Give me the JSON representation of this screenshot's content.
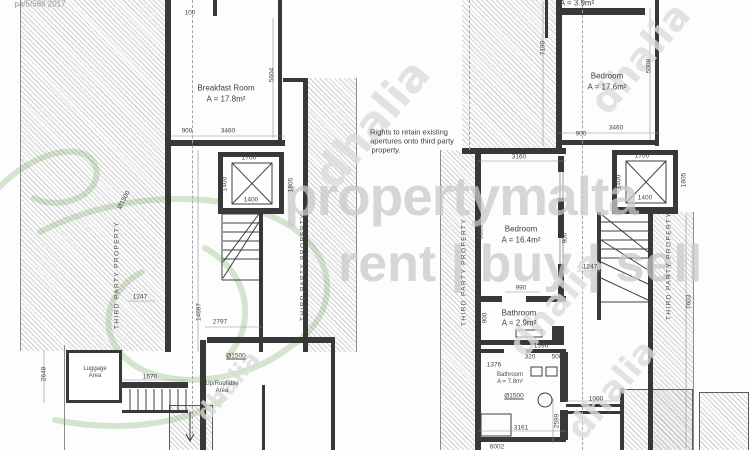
{
  "watermark": {
    "brand": "propertymalta",
    "tagline": "rent | buy | sell",
    "dhalia_text": "dhalia",
    "brand_color": "#c9c9c9",
    "dhalia_color": "#dcdcdc",
    "leaf_color": "#b9d6b0",
    "dhalia": [
      {
        "x": 640,
        "y": 58,
        "size": 38,
        "rot": -50
      },
      {
        "x": 372,
        "y": 124,
        "size": 44,
        "rot": -50
      },
      {
        "x": 556,
        "y": 304,
        "size": 36,
        "rot": -50
      },
      {
        "x": 228,
        "y": 386,
        "size": 24,
        "rot": -50
      },
      {
        "x": 612,
        "y": 390,
        "size": 34,
        "rot": -50
      }
    ]
  },
  "labels": [
    {
      "t": "pa/5/586 2017",
      "x": 40,
      "y": 4,
      "c": "ref",
      "n": "drawing-ref"
    },
    {
      "t": "100",
      "x": 190,
      "y": 13,
      "c": "dim"
    },
    {
      "t": "5604",
      "x": 272,
      "y": 75,
      "r": -90,
      "c": "dim"
    },
    {
      "t": "Breakfast Room",
      "x": 226,
      "y": 88,
      "c": "room",
      "n": "room-label-breakfast"
    },
    {
      "t": "A = 17.8m²",
      "x": 226,
      "y": 99,
      "c": "room",
      "n": "room-area-breakfast"
    },
    {
      "t": "900",
      "x": 187,
      "y": 131,
      "c": "dim"
    },
    {
      "t": "3460",
      "x": 228,
      "y": 131,
      "c": "dim"
    },
    {
      "t": "Ø1500",
      "x": 124,
      "y": 200,
      "r": -62,
      "c": "dim"
    },
    {
      "t": "1700",
      "x": 249,
      "y": 158,
      "c": "dim"
    },
    {
      "t": "1400",
      "x": 225,
      "y": 184,
      "r": -90,
      "c": "dim"
    },
    {
      "t": "1400",
      "x": 251,
      "y": 200,
      "c": "dim"
    },
    {
      "t": "1805",
      "x": 291,
      "y": 185,
      "r": -90,
      "c": "dim"
    },
    {
      "t": "1247",
      "x": 140,
      "y": 297,
      "c": "dim"
    },
    {
      "t": "THIRD PARTY PROPERTY",
      "x": 117,
      "y": 275,
      "r": -90,
      "c": "tpp",
      "n": "third-party-label"
    },
    {
      "t": "THIRD PARTY PROPERTY",
      "x": 303,
      "y": 267,
      "r": -90,
      "c": "tpp",
      "n": "third-party-label"
    },
    {
      "t": "14697",
      "x": 199,
      "y": 312,
      "r": -90,
      "c": "dim"
    },
    {
      "t": "2797",
      "x": 220,
      "y": 322,
      "c": "dim"
    },
    {
      "t": "Luggage",
      "x": 95,
      "y": 369,
      "c": "rooms",
      "n": "room-label-luggage"
    },
    {
      "t": "Area",
      "x": 95,
      "y": 376,
      "c": "rooms",
      "n": "room-label-luggage"
    },
    {
      "t": "1670",
      "x": 150,
      "y": 377,
      "c": "dim"
    },
    {
      "t": "Ø1500",
      "x": 236,
      "y": 356,
      "c": "dim under"
    },
    {
      "t": "Up/Roofable",
      "x": 222,
      "y": 384,
      "c": "rooms",
      "n": "room-label-roofable"
    },
    {
      "t": "Area",
      "x": 222,
      "y": 391,
      "c": "rooms",
      "n": "room-label-roofable"
    },
    {
      "t": "2648",
      "x": 44,
      "y": 374,
      "r": -90,
      "c": "dim"
    },
    {
      "t": "Rights to retain existing",
      "x": 409,
      "y": 132,
      "c": "note",
      "n": "apertures-note"
    },
    {
      "t": "apertures onto third party",
      "x": 412,
      "y": 141,
      "c": "note",
      "n": "apertures-note"
    },
    {
      "t": "property.",
      "x": 386,
      "y": 150,
      "c": "note",
      "n": "apertures-note"
    },
    {
      "t": "7190",
      "x": 543,
      "y": 48,
      "r": -90,
      "c": "dim"
    },
    {
      "t": "A = 3.9m²",
      "x": 577,
      "y": 3,
      "c": "room",
      "n": "room-area-top"
    },
    {
      "t": "Bedroom",
      "x": 607,
      "y": 76,
      "c": "room",
      "n": "room-label-bedroom-1"
    },
    {
      "t": "A = 17.6m²",
      "x": 607,
      "y": 87,
      "c": "room",
      "n": "room-area-bedroom-1"
    },
    {
      "t": "5008",
      "x": 649,
      "y": 66,
      "r": -90,
      "c": "dim"
    },
    {
      "t": "900",
      "x": 581,
      "y": 134,
      "c": "dim"
    },
    {
      "t": "3460",
      "x": 616,
      "y": 128,
      "c": "dim"
    },
    {
      "t": "1700",
      "x": 642,
      "y": 156,
      "c": "dim"
    },
    {
      "t": "1400",
      "x": 619,
      "y": 182,
      "r": -90,
      "c": "dim"
    },
    {
      "t": "1400",
      "x": 645,
      "y": 198,
      "c": "dim"
    },
    {
      "t": "1805",
      "x": 684,
      "y": 180,
      "r": -90,
      "c": "dim"
    },
    {
      "t": "3160",
      "x": 519,
      "y": 157,
      "c": "dim"
    },
    {
      "t": "Bedroom",
      "x": 521,
      "y": 229,
      "c": "room",
      "n": "room-label-bedroom-2"
    },
    {
      "t": "A = 16.4m²",
      "x": 521,
      "y": 240,
      "c": "room",
      "n": "room-area-bedroom-2"
    },
    {
      "t": "5359",
      "x": 481,
      "y": 232,
      "r": -90,
      "c": "dim"
    },
    {
      "t": "900",
      "x": 565,
      "y": 238,
      "r": -90,
      "c": "dim"
    },
    {
      "t": "1247",
      "x": 590,
      "y": 267,
      "c": "dim"
    },
    {
      "t": "THIRD PARTY PROPERTY",
      "x": 464,
      "y": 272,
      "r": -90,
      "c": "tpp",
      "n": "third-party-label"
    },
    {
      "t": "THIRD PARTY PROPERTY",
      "x": 669,
      "y": 266,
      "r": -90,
      "c": "tpp",
      "n": "third-party-label"
    },
    {
      "t": "7603",
      "x": 689,
      "y": 302,
      "r": -90,
      "c": "dim"
    },
    {
      "t": "990",
      "x": 521,
      "y": 288,
      "c": "dim"
    },
    {
      "t": "Bathroom",
      "x": 519,
      "y": 313,
      "c": "room",
      "n": "room-label-bathroom-1"
    },
    {
      "t": "A = 2.9m²",
      "x": 519,
      "y": 323,
      "c": "room",
      "n": "room-area-bathroom-1"
    },
    {
      "t": "900",
      "x": 485,
      "y": 318,
      "r": -90,
      "c": "dim"
    },
    {
      "t": "1596",
      "x": 541,
      "y": 346,
      "c": "dim"
    },
    {
      "t": "320",
      "x": 530,
      "y": 357,
      "c": "dim"
    },
    {
      "t": "500",
      "x": 557,
      "y": 357,
      "c": "dim"
    },
    {
      "t": "1376",
      "x": 494,
      "y": 365,
      "c": "dim"
    },
    {
      "t": "Bathroom",
      "x": 510,
      "y": 375,
      "c": "rooms",
      "n": "room-label-bathroom-2"
    },
    {
      "t": "A = 7.8m²",
      "x": 510,
      "y": 382,
      "c": "rooms",
      "n": "room-area-bathroom-2"
    },
    {
      "t": "Ø1500",
      "x": 514,
      "y": 396,
      "c": "dim under"
    },
    {
      "t": "3161",
      "x": 521,
      "y": 428,
      "c": "dim"
    },
    {
      "t": "2599",
      "x": 557,
      "y": 421,
      "r": -90,
      "c": "dim"
    },
    {
      "t": "1000",
      "x": 596,
      "y": 399,
      "c": "dim"
    },
    {
      "t": "6002",
      "x": 497,
      "y": 447,
      "c": "dim"
    }
  ]
}
